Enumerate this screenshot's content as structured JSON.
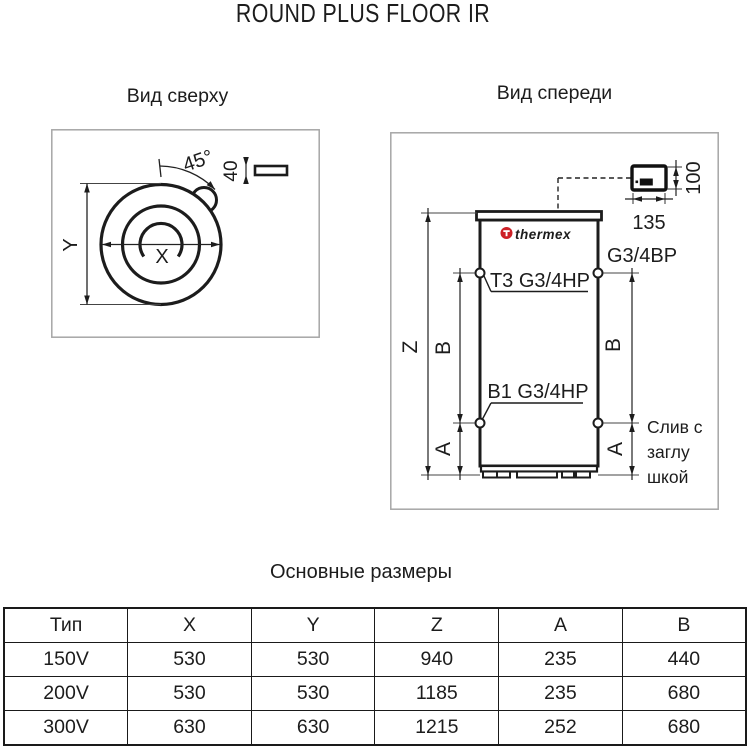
{
  "title": "ROUND PLUS FLOOR IR",
  "top_view": {
    "heading": "Вид сверху",
    "angle_label": "45°",
    "plate_width_label": "40",
    "dim_x_label": "X",
    "dim_y_label": "Y"
  },
  "front_view": {
    "heading": "Вид спереди",
    "brand": "thermex",
    "panel_height_label": "100",
    "panel_width_label": "135",
    "top_port_label": "Т3 G3/4НР",
    "right_port_label": "G3/4ВР",
    "bottom_port_label": "В1 G3/4НР",
    "drain_caption": [
      "Слив с",
      "заглу",
      "шкой"
    ],
    "dim_z_label": "Z",
    "dim_b_label": "B",
    "dim_a_label": "A"
  },
  "table": {
    "heading": "Основные размеры",
    "columns": [
      "Тип",
      "X",
      "Y",
      "Z",
      "A",
      "B"
    ],
    "rows": [
      [
        "150V",
        "530",
        "530",
        "940",
        "235",
        "440"
      ],
      [
        "200V",
        "530",
        "530",
        "1185",
        "235",
        "680"
      ],
      [
        "300V",
        "630",
        "630",
        "1215",
        "252",
        "680"
      ]
    ]
  },
  "colors": {
    "brand_red": "#cc2127",
    "line_black": "#1c1c1c",
    "frame_gray": "#a6a6a6"
  }
}
